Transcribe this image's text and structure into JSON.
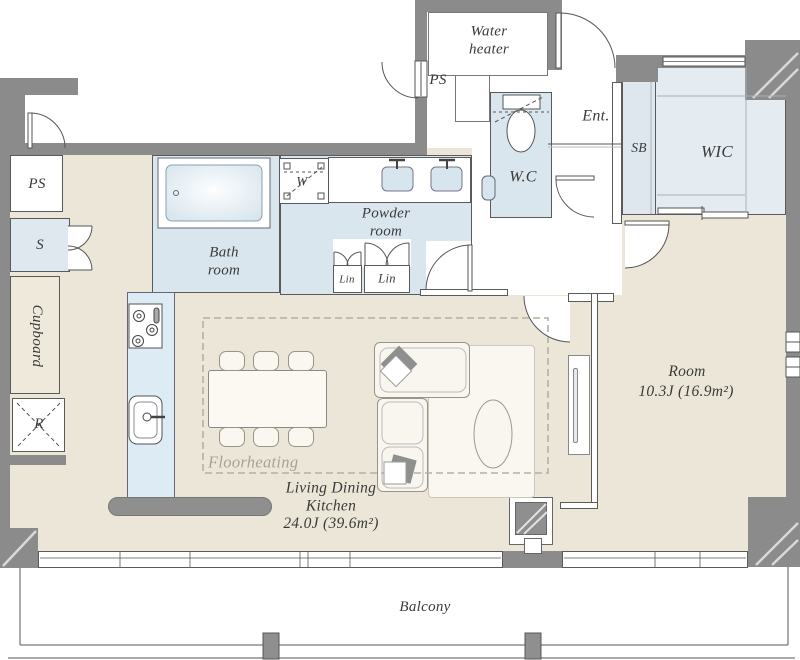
{
  "plan_type": "apartment-floor-plan",
  "colors": {
    "wall": "#8b8b8b",
    "floor_beige": "#ece6d8",
    "wet_room_blue": "#d9e6ed",
    "closet_blue": "#e4ebf1",
    "kitchen_counter": "#dcebf4",
    "accent_gray": "#8f8f8f",
    "line": "#5a5a5a",
    "text": "#3b3b3b",
    "hint_text": "#a8a195"
  },
  "rooms": {
    "water_heater": "Water\nheater",
    "ps_top": "PS",
    "ent": "Ent.",
    "sb": "SB",
    "wic": "WIC",
    "wc": "W.C",
    "washer": "W",
    "powder": "Powder\nroom",
    "bath": "Bath\nroom",
    "lin1": "Lin",
    "lin2": "Lin",
    "ps_left": "PS",
    "s_closet": "S",
    "cupboard": "Cupboard",
    "fridge": "R",
    "room_name": "Room",
    "room_area": "10.3J (16.9m²)",
    "ldk_name": "Living Dining\nKitchen",
    "ldk_area": "24.0J (39.6m²)",
    "floorheating": "Floorheating",
    "balcony": "Balcony"
  }
}
